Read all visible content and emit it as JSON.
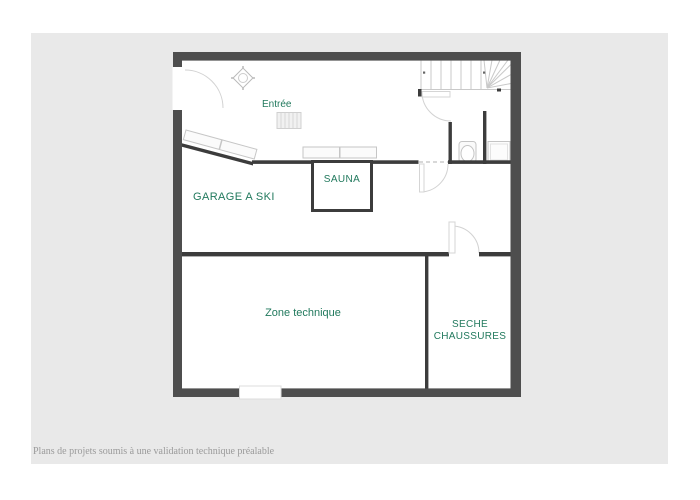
{
  "canvas": {
    "background": "#ffffff",
    "panel_background": "#e9e9e9"
  },
  "colors": {
    "outer_wall": "#4e4e4e",
    "inner_wall": "#3c3c3c",
    "label_green": "#21795d",
    "fixture_outline": "#c6c6c6",
    "footer_gray": "#9a9a9a"
  },
  "floor_plan": {
    "type": "basement-floor-plan",
    "rooms": [
      {
        "id": "entree",
        "label": "Entrée"
      },
      {
        "id": "sauna",
        "label": "SAUNA"
      },
      {
        "id": "garage-a-ski",
        "label": "GARAGE A SKI"
      },
      {
        "id": "zone-technique",
        "label": "Zone technique"
      },
      {
        "id": "seche-chaussures",
        "label": "SECHE CHAUSSURES"
      }
    ],
    "fixtures": [
      "staircase-with-winders",
      "entrance-door-swing",
      "door-mat",
      "structural-column",
      "ski-rack-benches",
      "wall-bench",
      "toilet",
      "shower-tray",
      "interior-door-swings",
      "window-opening"
    ]
  },
  "footer": {
    "disclaimer": "Plans de projets soumis à une validation technique préalable"
  }
}
